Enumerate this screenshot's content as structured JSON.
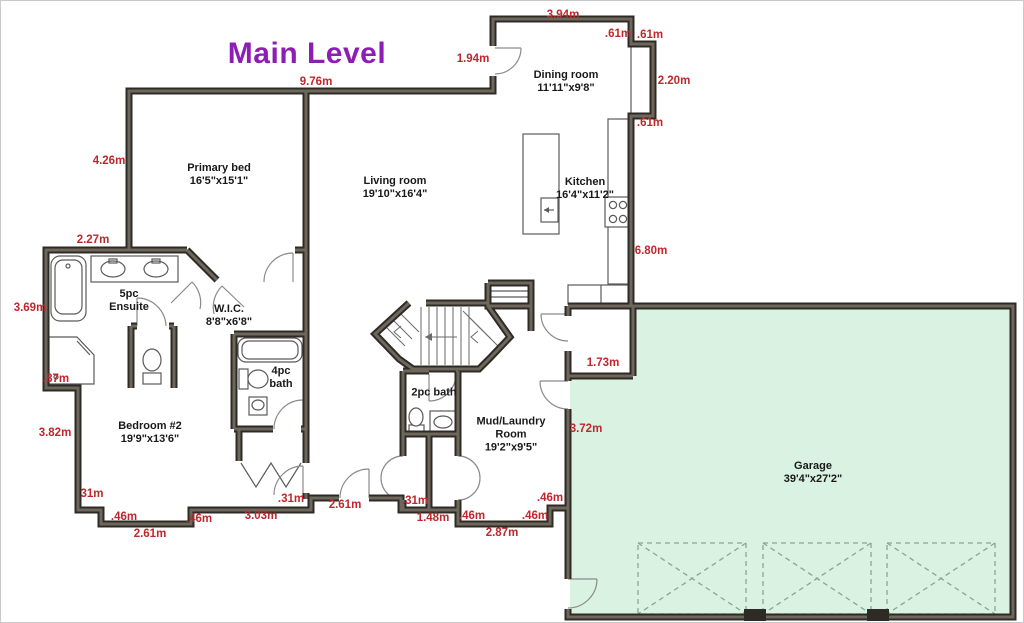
{
  "title": {
    "text": "Main Level"
  },
  "colors": {
    "title": "#8e1db5",
    "dimension_text": "#c0272d",
    "room_text": "#191919",
    "wall_dark": "#2e2b26",
    "wall_light": "#6e675b",
    "garage_fill": "#d9f2e2"
  },
  "rooms": [
    {
      "name": "Primary bed",
      "size": "16'5\"x15'1\""
    },
    {
      "name": "Living room",
      "size": "19'10\"x16'4\""
    },
    {
      "name": "Dining room",
      "size": "11'11\"x9'8\""
    },
    {
      "name": "Kitchen",
      "size": "16'4\"x11'2\""
    },
    {
      "name": "5pc Ensuite",
      "size": ""
    },
    {
      "name": "W.I.C.",
      "size": "8'8\"x6'8\""
    },
    {
      "name": "4pc bath",
      "size": ""
    },
    {
      "name": "2pc bath",
      "size": ""
    },
    {
      "name": "Mud/Laundry Room",
      "size": "19'2\"x9'5\""
    },
    {
      "name": "Bedroom #2",
      "size": "19'9\"x13'6\""
    },
    {
      "name": "Garage",
      "size": "39'4\"x27'2\""
    }
  ],
  "dimensions": [
    {
      "text": "3.94m"
    },
    {
      "text": ".61m"
    },
    {
      "text": ".61m"
    },
    {
      "text": "1.94m"
    },
    {
      "text": "2.20m"
    },
    {
      "text": ".61m"
    },
    {
      "text": "9.76m"
    },
    {
      "text": "4.26m"
    },
    {
      "text": "2.27m"
    },
    {
      "text": "3.69m"
    },
    {
      "text": "6.80m"
    },
    {
      "text": ".87m"
    },
    {
      "text": "1.73m"
    },
    {
      "text": "3.82m"
    },
    {
      "text": "3.72m"
    },
    {
      "text": "31m"
    },
    {
      "text": ".46m"
    },
    {
      "text": "2.61m"
    },
    {
      "text": ".46m"
    },
    {
      "text": "3.03m"
    },
    {
      "text": ".31m"
    },
    {
      "text": "2.61m"
    },
    {
      "text": ".31m"
    },
    {
      "text": "1.48m"
    },
    {
      "text": ".46m"
    },
    {
      "text": "2.87m"
    },
    {
      "text": ".46m"
    },
    {
      "text": ".46m"
    }
  ]
}
